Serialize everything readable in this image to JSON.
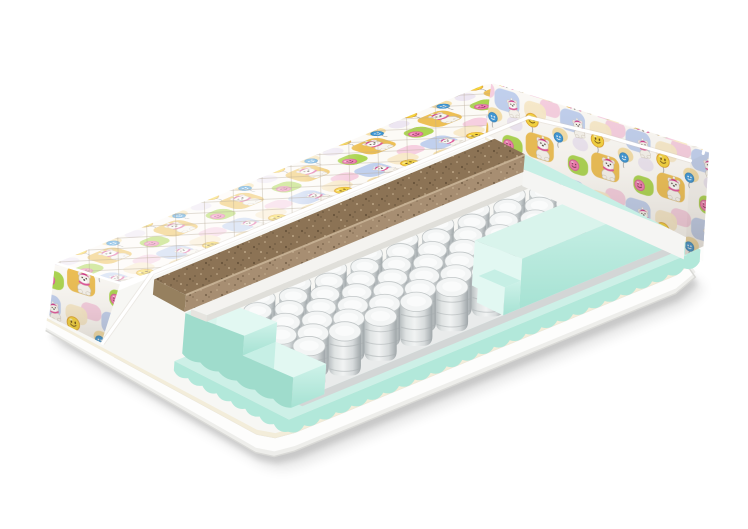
{
  "product": {
    "kind": "children-spring-mattress-cutaway-render",
    "background": "#ffffff",
    "view": "three-quarter perspective, corner cutaway exposing internal layers"
  },
  "construction": {
    "spring_grid": {
      "rows": 7,
      "cols": 10
    },
    "layers": [
      {
        "name": "quilted-cover",
        "color": "#fbf8f3",
        "description": "printed quilted fabric with bears and balloons"
      },
      {
        "name": "coconut-coir-board",
        "color": "#8c7355"
      },
      {
        "name": "felt-pad",
        "color": "#f4f3f0"
      },
      {
        "name": "independent-pocket-springs",
        "color": "#dfe3e3"
      },
      {
        "name": "foam-side-rails",
        "color": "#b2e8da"
      },
      {
        "name": "foam-base-layer",
        "color": "#c6efe5"
      },
      {
        "name": "mattress-base-cover",
        "color": "#fdfdfc"
      }
    ],
    "pattern_motifs": [
      "polar-bear-cub",
      "yellow-smiley-balloon",
      "pink-smiley-balloon",
      "blue-balloon",
      "pastel-quilt-patches"
    ]
  },
  "palette": {
    "coverBase": "#fcfaf6",
    "patchGold": "#ecb843",
    "patchGoldSoft": "#f3d489",
    "patchBlue": "#b6c9ec",
    "patchGreen": "#a3d13f",
    "patchPink": "#f4c0d8",
    "patchCream": "#f7e9c8",
    "patchLilac": "#e3d9f0",
    "bearBody": "#f7f4ee",
    "bearLine": "#c9c0b2",
    "bearDark": "#42382e",
    "bearScarf": "#e0559a",
    "bearHat": "#cf2f88",
    "bearCheek": "#f4b8cf",
    "smileyYellow": "#f5d43e",
    "smileyYellowEdge": "#dd9b26",
    "smileyFaceBrown": "#6b4e12",
    "smileyPink": "#f07fb0",
    "smileyPinkEdge": "#d55f96",
    "smileyPinkFace": "#7d2c55",
    "balloonBlue": "#3e97d7",
    "balloonBlueEdge": "#2e7fb8",
    "stringGray": "#8a8a8a",
    "coirTop": "#8c7355",
    "coirFace": "#a78e72",
    "coirFaceLight": "#bfa88c",
    "coirShade": "#96805f",
    "coirEdgeHi": "#c8b296",
    "coirSpeckDark": "#5f4c35",
    "coirSpeckMid": "#6e5a41",
    "coirSpeckLight": "#d8c4a4",
    "felt": "#f4f3f0",
    "feltEdge": "#e0dfda",
    "mintTop": "#d9f4ec",
    "mintMid": "#c6efe5",
    "mintLight": "#cdf0e7",
    "mintFace": "#b2e8da",
    "mintFaceDeep": "#9fdccc",
    "mintCut": "#e2f8f2",
    "mintFaceTop": "#cef2e9",
    "mintFaceBot": "#a6e2d3",
    "springEdgeL": "#b9bfc1",
    "springMid": "#dfe3e3",
    "springHi": "#f1f3f3",
    "springMid2": "#d7dbdc",
    "springEdgeR": "#9fa6a9",
    "springCrease": "#a6acae",
    "springTopFace": "#f3f5f5",
    "springTopEdge": "#c2c7c8",
    "platformTop": "#e9ebeb",
    "platformEdge": "#d3d6d6",
    "baseTop": "#f7f7f4",
    "baseFace": "#fdfdfc",
    "baseEdgeLine": "#d9d9d6",
    "cream": "#f2ecd8",
    "pipe": "#ffffff",
    "seam": "#cfc8bc",
    "quilt": "#b9ac99",
    "shadow": "#000000"
  }
}
